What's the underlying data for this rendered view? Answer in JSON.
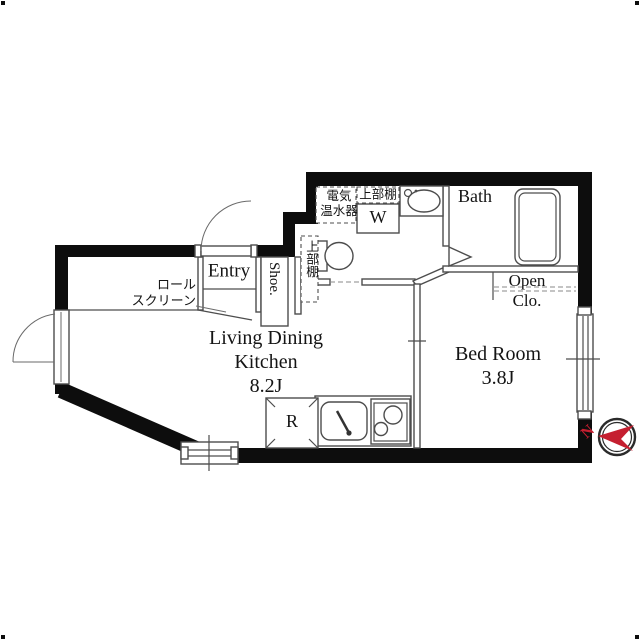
{
  "floorplan": {
    "rooms": {
      "ldk": {
        "label_line1": "Living Dining",
        "label_line2": "Kitchen",
        "size": "8.2J"
      },
      "bedroom": {
        "label": "Bed Room",
        "size": "3.8J"
      },
      "bath": {
        "label": "Bath"
      },
      "entry": {
        "label": "Entry"
      },
      "shoe": {
        "label": "Shoe."
      },
      "open_closet": {
        "label_line1": "Open",
        "label_line2": "Clo."
      }
    },
    "fixtures": {
      "washer_label": "W",
      "refrigerator_label": "R",
      "water_heater_line1": "電気",
      "water_heater_line2": "温水器",
      "upper_shelf_top": "上部棚",
      "upper_shelf_side": "上部棚",
      "roll_screen_line1": "ロール",
      "roll_screen_line2": "スクリーン"
    },
    "compass": {
      "north": "N"
    },
    "colors": {
      "wall": "#0d0d0d",
      "interior_line": "#4d4d4d",
      "compass_red": "#c51f30",
      "background": "#ffffff"
    }
  }
}
